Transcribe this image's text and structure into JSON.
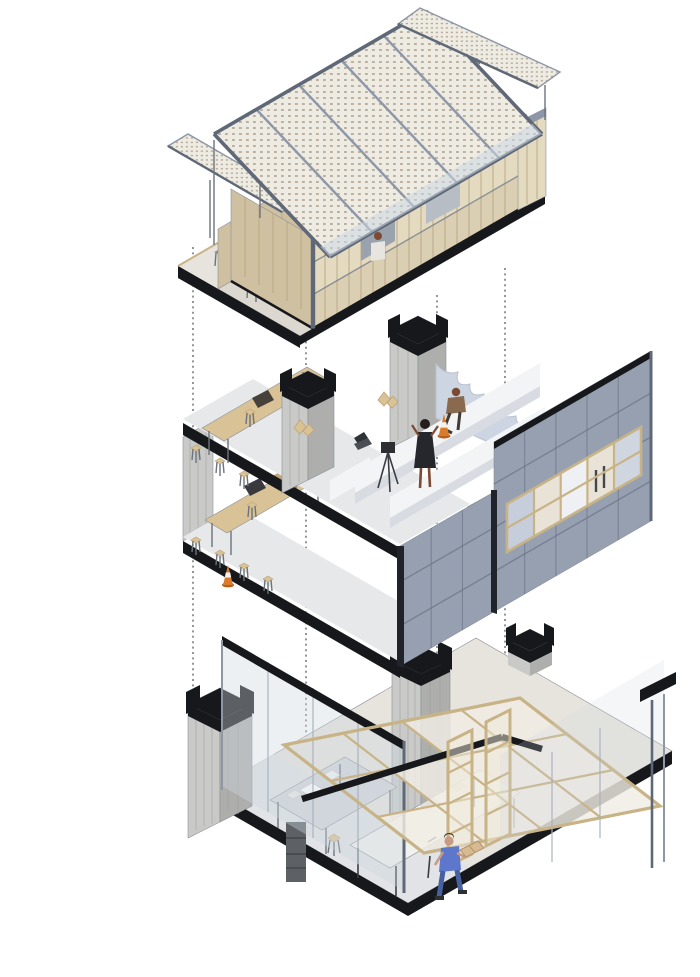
{
  "scene": {
    "type": "exploded-axonometric-architecture-diagram",
    "subject": "three-level modular timber and steel building, levels separated vertically and linked by dotted projection lines",
    "background": "#ffffff"
  },
  "palette": {
    "bg": "#ffffff",
    "ink": "#17181b",
    "steel": "#8d97a8",
    "steel-light": "#aeb6c3",
    "steel-dark": "#5f6877",
    "clad": "#97a0b1",
    "clad-seam": "#6a7487",
    "timber": "#e4dabf",
    "timber-dark": "#cec0a1",
    "timber-frame": "#c8b386",
    "timber-stud": "#b3a07c",
    "ply": "#d9c295",
    "ply-dark": "#bfa476",
    "roof-panel": "#edebe2",
    "roof-dot": "#a08f7b",
    "concrete": "#c9cac8",
    "concrete-dark": "#aeafad",
    "concrete-streak": "#9d9e9c",
    "floor": "#e6e8ea",
    "floor-cool": "#dfe3e7",
    "floor-warm": "#e7e4dd",
    "wavy-wall": "#cdd5e2",
    "partition": "#f3f4f6",
    "partition-shade": "#d8dce2",
    "glass-edge": "#a9b3bf",
    "window-gray": "#9aa3ad",
    "cone": "#d87c2c",
    "denim": "#5d78cb",
    "denim-dark": "#47609f",
    "skin": "#c79a82",
    "skin-dark": "#7c4a32",
    "figure-dark": "#2e2f33",
    "table-gray": "#d2d6da",
    "table-white": "#f1f1ee",
    "box-tan": "#d8ba92",
    "chair-gray": "#8a9097"
  },
  "levels": [
    {
      "id": "roof-pavilion",
      "elements": [
        "perforated-solar-roof",
        "clerestory-panel-row",
        "sloped-terrace-panel",
        "timber-stud-wall",
        "window-openings",
        "roof-terrace",
        "terrace-chairs",
        "figure-at-window",
        "figure-on-terrace",
        "steel-frame"
      ]
    },
    {
      "id": "workspace-module",
      "elements": [
        "metal-clad-facade",
        "timber-window-band",
        "plywood-work-tables",
        "bar-stools",
        "white-partition-desks",
        "laptop",
        "camera-tripod",
        "traffic-cones",
        "standing-figure",
        "seated-figure",
        "concrete-columns-with-black-caps",
        "cut-concrete-wavy-wall"
      ]
    },
    {
      "id": "ground-floor-workshop",
      "elements": [
        "floor-slab",
        "glass-facade",
        "tilted-timber-grid-canopy",
        "concrete-columns-with-black-caps",
        "timber-shelf-frames",
        "gray-model-table",
        "long-work-table",
        "stools",
        "figure-carrying-box"
      ]
    }
  ],
  "connectors": {
    "style": "dotted",
    "count": 4,
    "xs": [
      193,
      306,
      437,
      505
    ]
  }
}
